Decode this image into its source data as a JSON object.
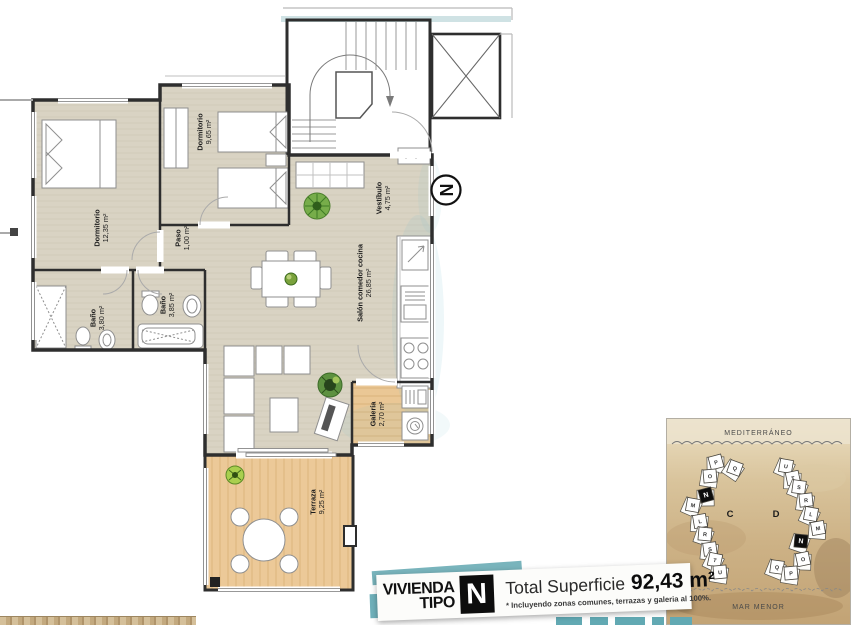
{
  "plan": {
    "north_label": "N",
    "rooms": [
      {
        "name": "Dormitorio",
        "area": "12,35 m²"
      },
      {
        "name": "Dormitorio",
        "area": "9,65 m²"
      },
      {
        "name": "Paso",
        "area": "1,00 m²"
      },
      {
        "name": "Baño",
        "area": "3,80 m²"
      },
      {
        "name": "Baño",
        "area": "3,85 m²"
      },
      {
        "name": "Vestíbulo",
        "area": "4,75 m²"
      },
      {
        "name": "Salón comedor cocina",
        "area": "26,85 m²"
      },
      {
        "name": "Galería",
        "area": "2,70 m²"
      },
      {
        "name": "Terraza",
        "area": "9,25 m²"
      }
    ]
  },
  "badge": {
    "line1": "VIVIENDA",
    "line2": "TIPO",
    "type_letter": "N",
    "total_label": "Total Superficie",
    "total_value": "92,43 m²",
    "footnote": "* Incluyendo zonas comunes, terrazas y galeria al 100%."
  },
  "siteplan": {
    "sea_top": "MEDITERRÁNEO",
    "sea_bottom": "MAR MENOR",
    "blocks": [
      {
        "label": "C",
        "highlight_unit": "N",
        "units": [
          "P",
          "Q",
          "O",
          "N",
          "M",
          "L",
          "R",
          "S",
          "T",
          "U"
        ]
      },
      {
        "label": "D",
        "highlight_unit": "N",
        "units": [
          "U",
          "T",
          "S",
          "R",
          "L",
          "M",
          "N",
          "O",
          "Q",
          "P"
        ]
      }
    ]
  },
  "colors": {
    "accent_teal": "#6fb0ba",
    "floor_beige": "#d9d3c3",
    "wood": "#ecc998",
    "sand": "#cdb489",
    "wall": "#2e2e2e",
    "plant_green": "#5a9e3a"
  }
}
